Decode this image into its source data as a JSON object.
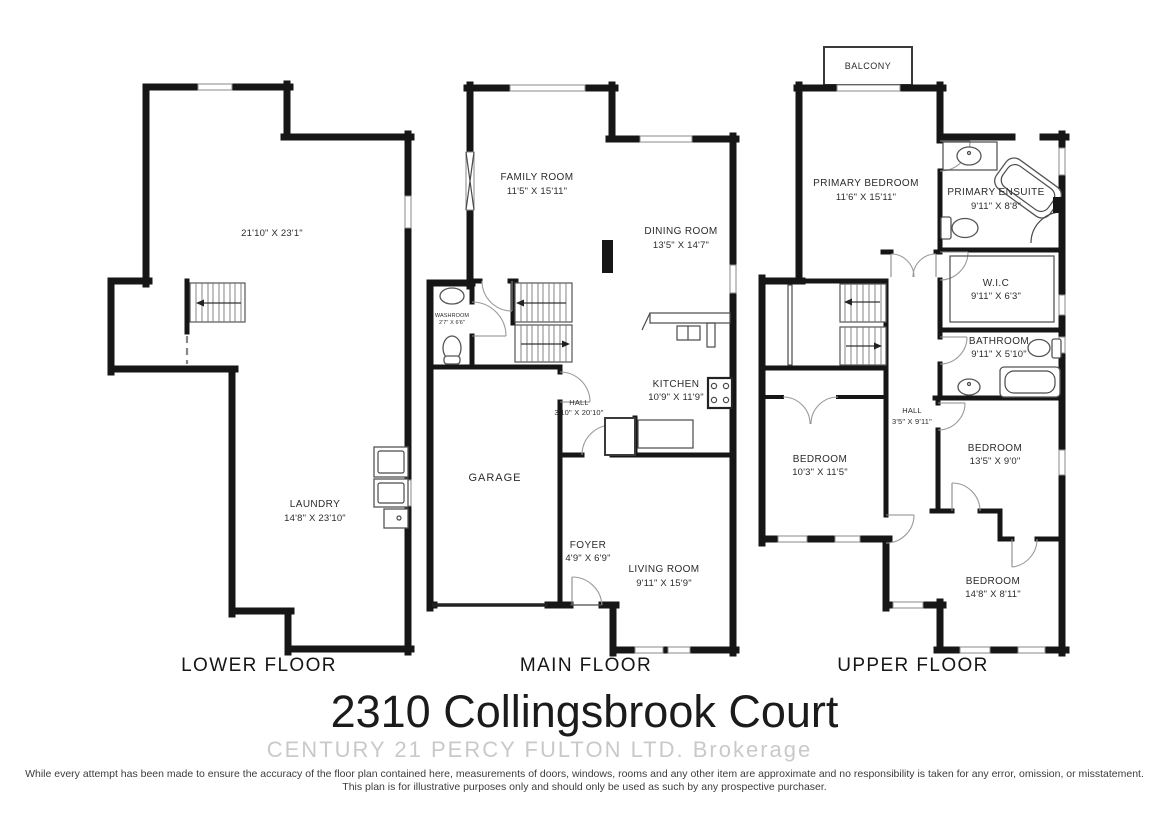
{
  "title": "2310 Collingsbrook Court",
  "watermark": "CENTURY 21 PERCY FULTON LTD.  Brokerage",
  "disclaimer": {
    "line1": "While every attempt has been made to ensure the accuracy of the floor plan contained here, measurements of doors, windows, rooms and any other item are approximate and no responsibility is taken for any error, omission, or misstatement.",
    "line2": "This plan is for illustrative purposes only and should only be used as such by any prospective purchaser."
  },
  "colors": {
    "wall": "#161616",
    "door_arc": "#9a9a9a",
    "label": "#2b2b2b",
    "watermark": "#c9c9c9"
  },
  "floors": {
    "lower": {
      "label": "LOWER FLOOR",
      "rooms": {
        "rec_room": {
          "name": "",
          "dims": "21'10\" X 23'1\""
        },
        "laundry": {
          "name": "LAUNDRY",
          "dims": "14'8\" X 23'10\""
        }
      }
    },
    "main": {
      "label": "MAIN FLOOR",
      "rooms": {
        "family_room": {
          "name": "FAMILY ROOM",
          "dims": "11'5\" X 15'11\""
        },
        "dining_room": {
          "name": "DINING ROOM",
          "dims": "13'5\" X 14'7\""
        },
        "washroom": {
          "name": "WASHROOM",
          "dims": "2'7\" X 6'6\""
        },
        "kitchen": {
          "name": "KITCHEN",
          "dims": "10'9\" X 11'9\""
        },
        "hall": {
          "name": "HALL",
          "dims": "3'10\" X 20'10\""
        },
        "garage": {
          "name": "GARAGE",
          "dims": ""
        },
        "foyer": {
          "name": "FOYER",
          "dims": "4'9\" X 6'9\""
        },
        "living_room": {
          "name": "LIVING ROOM",
          "dims": "9'11\" X 15'9\""
        }
      }
    },
    "upper": {
      "label": "UPPER FLOOR",
      "rooms": {
        "balcony": {
          "name": "BALCONY",
          "dims": ""
        },
        "primary_bedroom": {
          "name": "PRIMARY BEDROOM",
          "dims": "11'6\" X 15'11\""
        },
        "primary_ensuite": {
          "name": "PRIMARY ENSUITE",
          "dims": "9'11\" X 8'8\""
        },
        "wic": {
          "name": "W.I.C",
          "dims": "9'11\" X 6'3\""
        },
        "bathroom": {
          "name": "BATHROOM",
          "dims": "9'11\" X 5'10\""
        },
        "hall": {
          "name": "HALL",
          "dims": "3'5\" X 9'11\""
        },
        "bedroom_1": {
          "name": "BEDROOM",
          "dims": "10'3\" X 11'5\""
        },
        "bedroom_2": {
          "name": "BEDROOM",
          "dims": "13'5\" X 9'0\""
        },
        "bedroom_3": {
          "name": "BEDROOM",
          "dims": "14'8\" X 8'11\""
        }
      }
    }
  }
}
